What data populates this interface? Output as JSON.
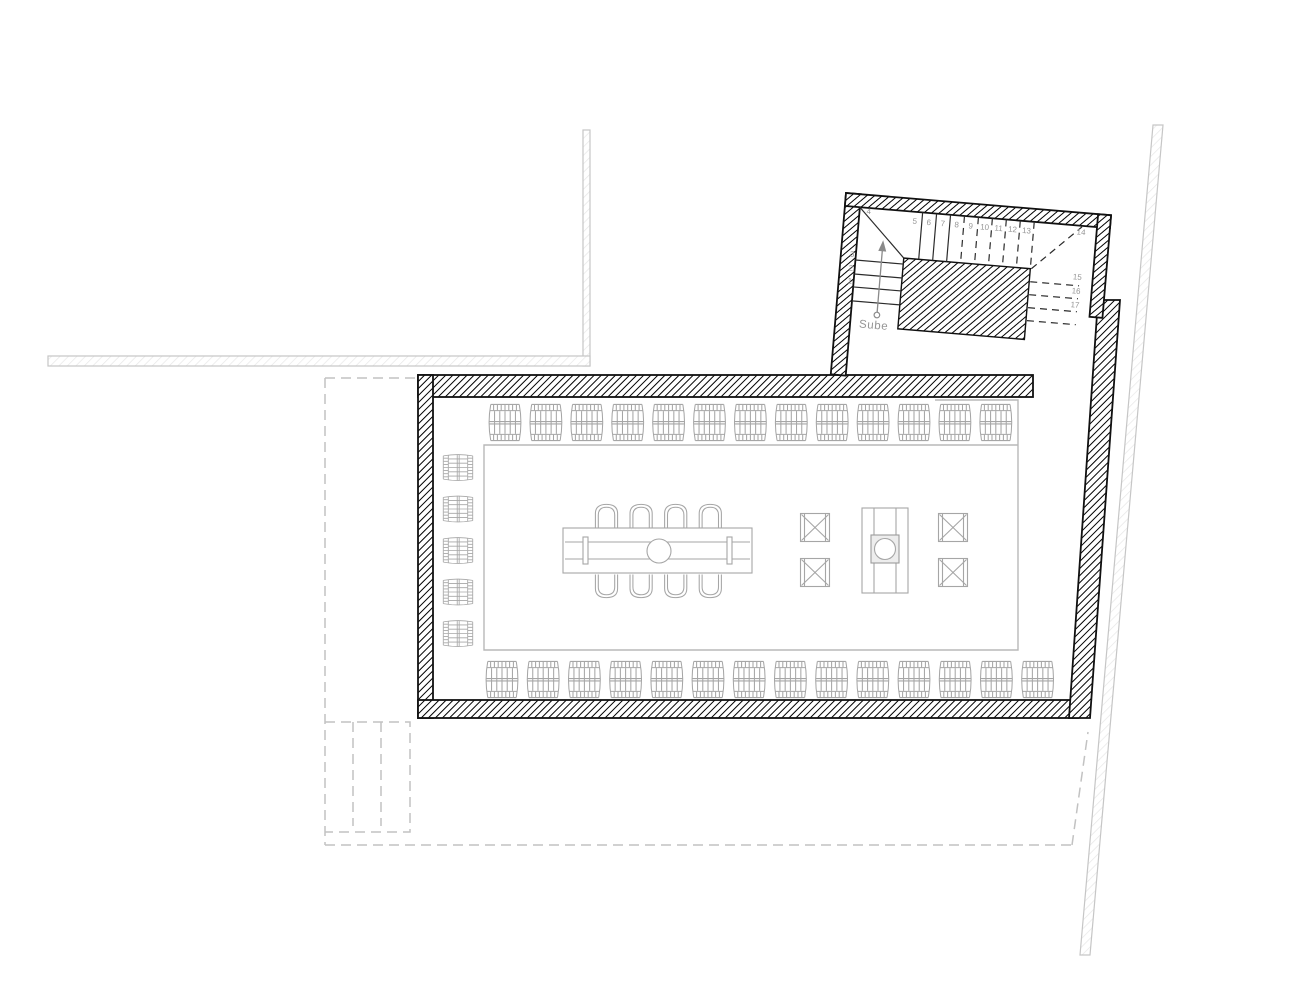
{
  "plan": {
    "stair": {
      "direction_label": "Sube",
      "steps": [
        "1",
        "2",
        "3",
        "4",
        "5",
        "6",
        "7",
        "8",
        "9",
        "10",
        "11",
        "12",
        "13",
        "14",
        "15",
        "16",
        "17"
      ]
    },
    "furniture": {
      "barrels_top_row": 13,
      "barrels_bottom_row": 14,
      "barrels_left_column": 5,
      "dining_chairs_top": 4,
      "dining_chairs_bottom": 4,
      "stools": 4
    },
    "colors": {
      "wall_outline": "#111111",
      "furniture_line": "#a6a6a6",
      "dashed_line": "#c2c2c2",
      "light_wall_line": "#c6c6c6",
      "label_text": "#959595"
    }
  }
}
